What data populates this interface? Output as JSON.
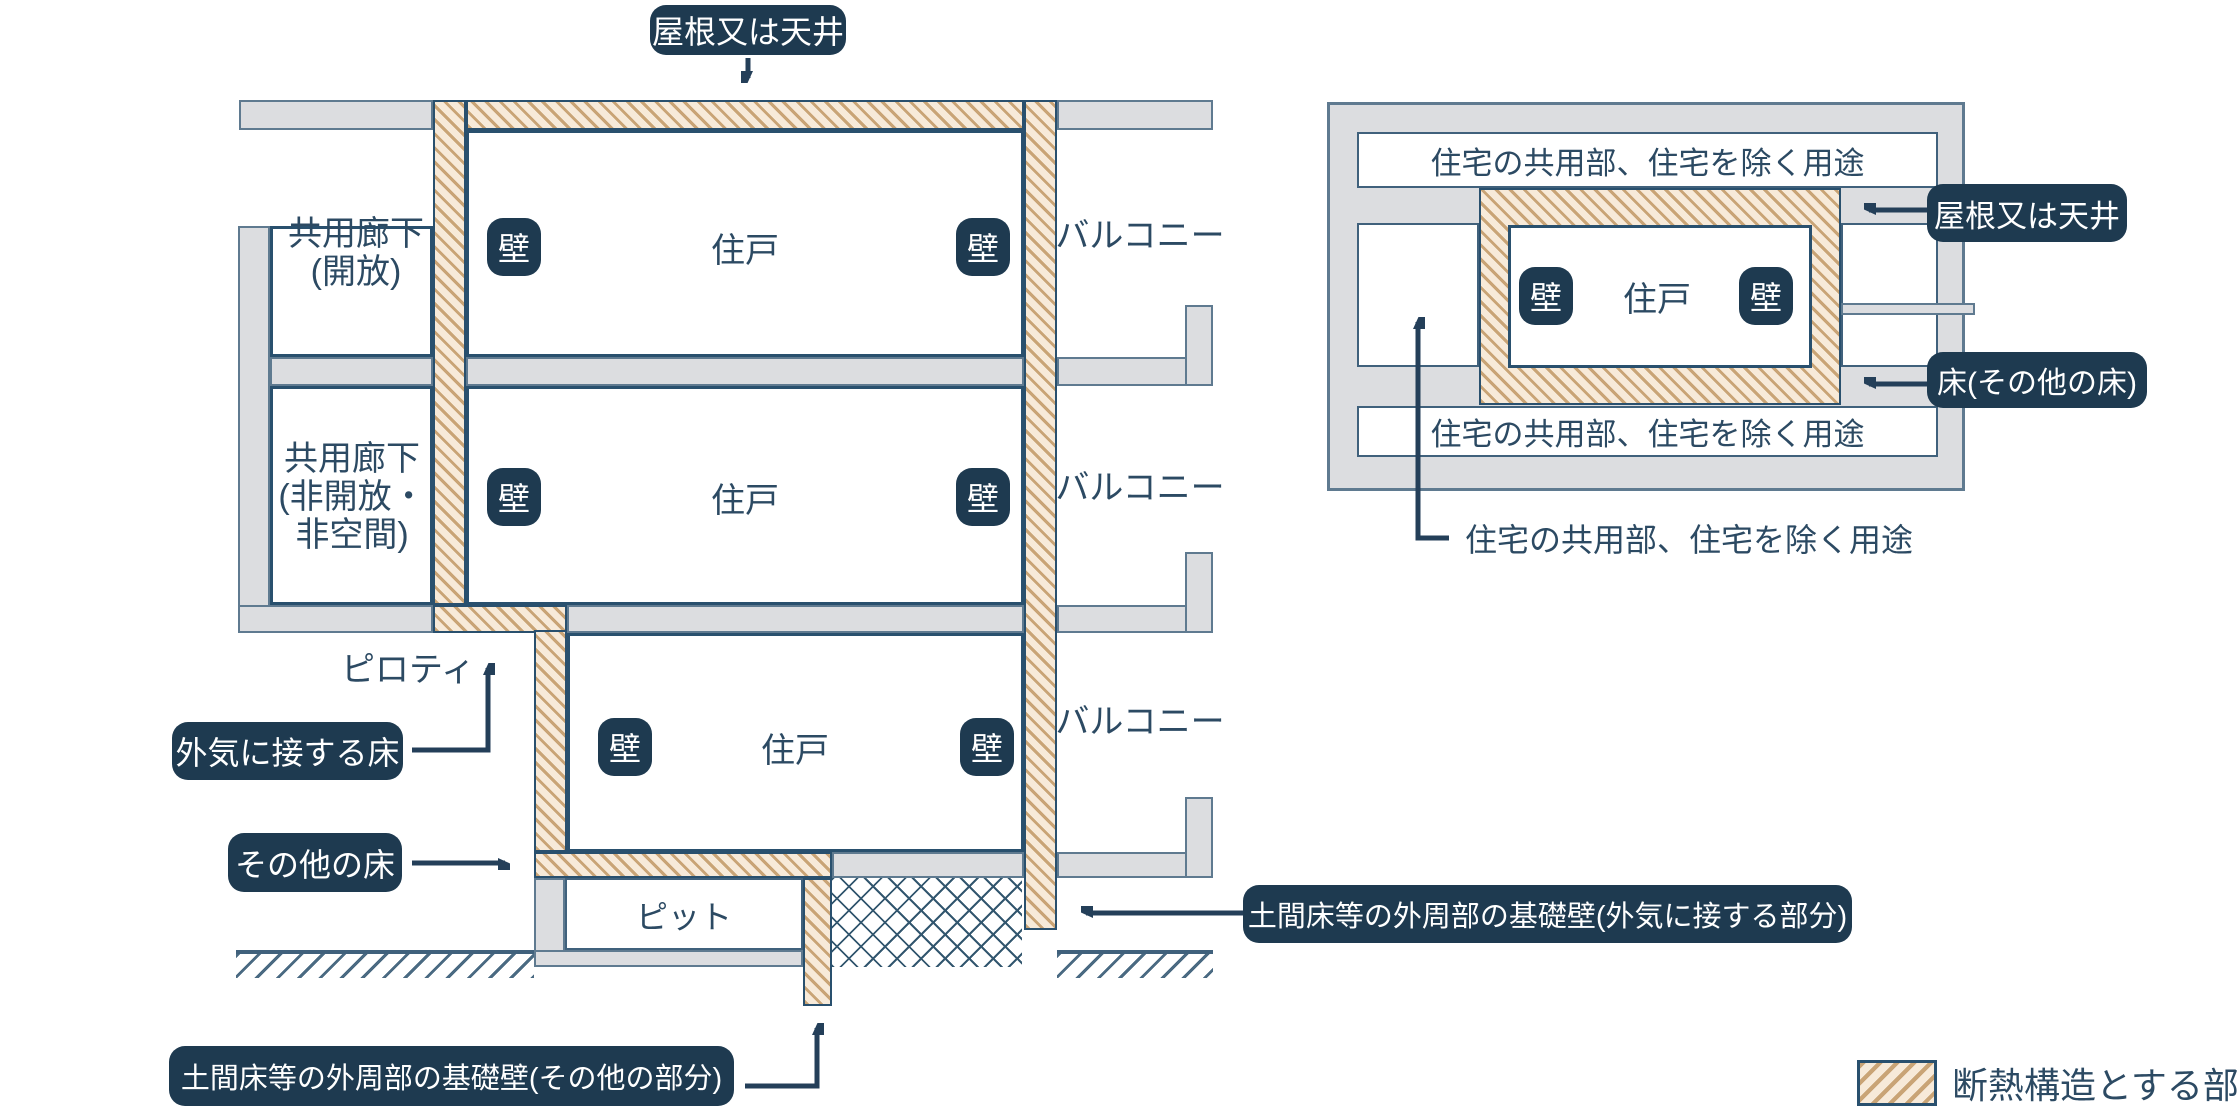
{
  "legend": {
    "label": "断熱構造とする部分"
  },
  "shared": {
    "unit": "住戸",
    "wall": "壁",
    "balcony": "バルコニー"
  },
  "left": {
    "badge_roof": "屋根又は天井",
    "badge_outside_floor": "外気に接する床",
    "badge_other_floor": "その他の床",
    "badge_foundation_other": "土間床等の外周部の基礎壁(その他の部分)",
    "badge_foundation_outside": "土間床等の外周部の基礎壁(外気に接する部分)",
    "corridor_open": [
      "共用廊下",
      "(開放)"
    ],
    "corridor_closed": [
      "共用廊下",
      "(非開放・",
      "非空間)"
    ],
    "pilotis": "ピロティ",
    "pit": "ピット"
  },
  "right": {
    "common_area": "住宅の共用部、住宅を除く用途",
    "badge_roof": "屋根又は天井",
    "badge_floor": "床(その他の床)"
  }
}
